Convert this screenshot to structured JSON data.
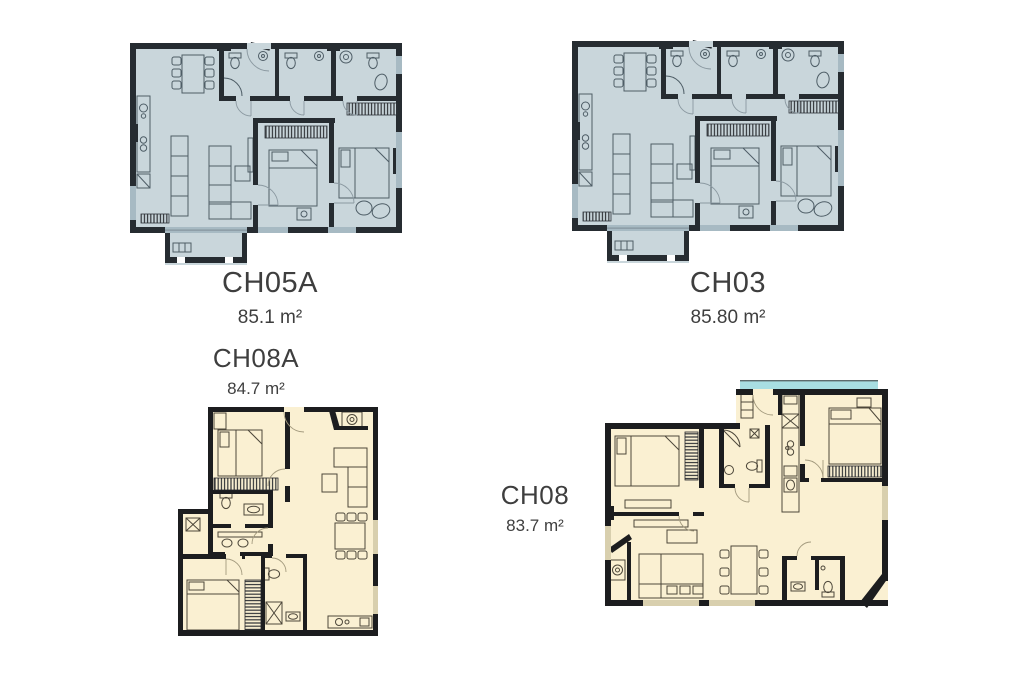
{
  "page": {
    "background": "#ffffff"
  },
  "colors": {
    "blue_plan_fill": "#c9d6db",
    "cream_plan_fill": "#faf0d2",
    "teal_balcony": "#a8dee2",
    "wall_dark": "#1c1d1f",
    "label_text": "#3e3e3e"
  },
  "plans": [
    {
      "code": "CH05A",
      "area": "85.1 m²",
      "style": "blue"
    },
    {
      "code": "CH03",
      "area": "85.80 m²",
      "style": "blue"
    },
    {
      "code": "CH08A",
      "area": "84.7 m²",
      "style": "cream"
    },
    {
      "code": "CH08",
      "area": "83.7 m²",
      "style": "cream"
    }
  ]
}
